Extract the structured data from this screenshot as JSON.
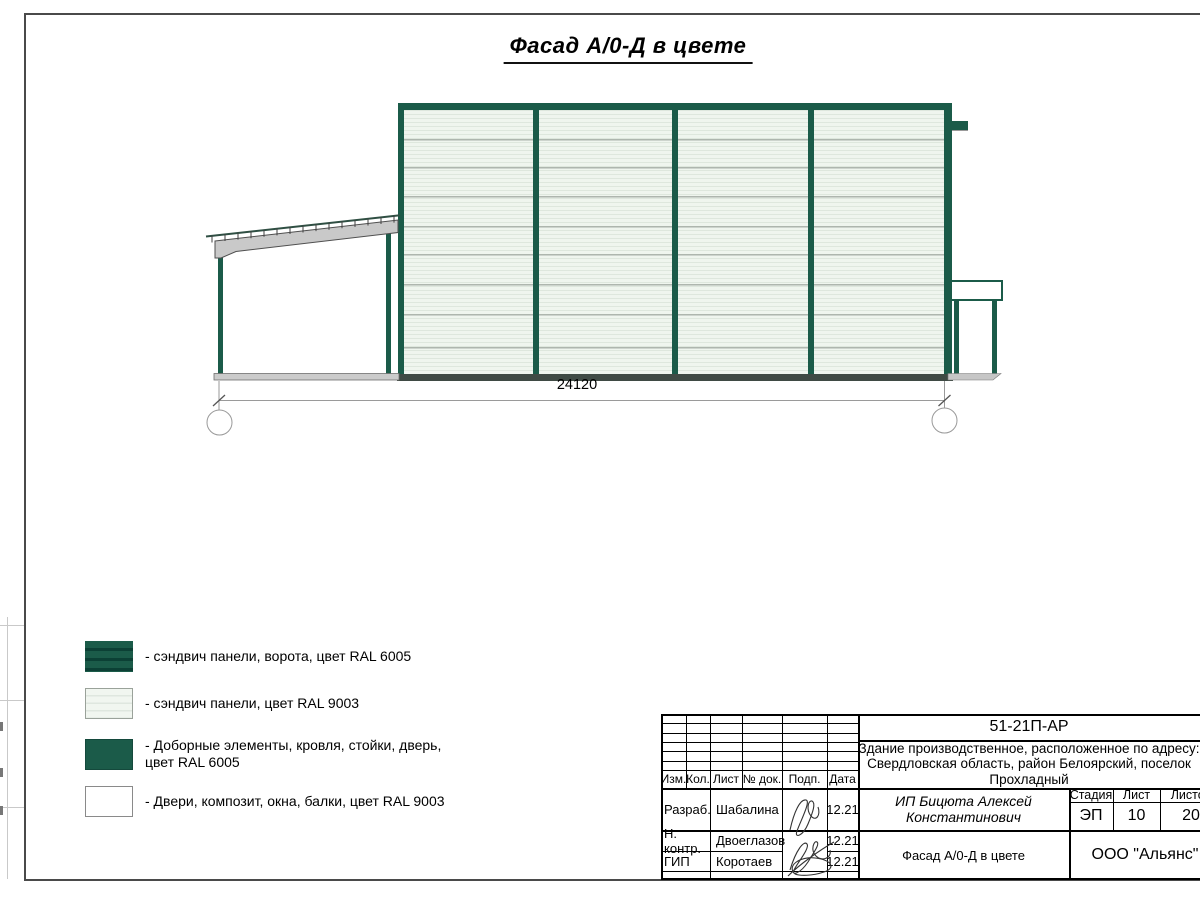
{
  "sheet": {
    "title": "Фасад А/0-Д в цвете"
  },
  "facade": {
    "dimension": "24120",
    "axis_left": "А/0",
    "axis_right": "Д"
  },
  "legend": {
    "items": [
      {
        "swatch": "gate-sandwich-panel-ral6005",
        "label": "- сэндвич панели, ворота, цвет RAL 6005"
      },
      {
        "swatch": "sandwich-panel-ral9003",
        "label": "- сэндвич панели, цвет RAL 9003"
      },
      {
        "swatch": "trim-elements-ral6005",
        "label": "- Доборные элементы, кровля, стойки, дверь,\nцвет RAL 6005"
      },
      {
        "swatch": "doors-windows-ral9003",
        "label": "- Двери, композит, окна, балки, цвет RAL 9003"
      }
    ]
  },
  "colors": {
    "ral6005": "#1b5b49",
    "ral6005_dark": "#0c4035",
    "ral9003": "#eff5ee",
    "panel_joint": "#9ea79e",
    "steel_gray": "#c9c9c9"
  },
  "title_block": {
    "doc_code": "51-21П-АР",
    "project": "Здание производственное, расположенное по адресу:\nСвердловская область, район Белоярский, поселок\nПрохладный",
    "columns": {
      "izm": "Изм.",
      "kol": "Кол.",
      "list": "Лист",
      "doc": "№ док.",
      "podp": "Подп.",
      "data": "Дата"
    },
    "rows": [
      {
        "role": "Разраб.",
        "name": "Шабалина",
        "date": "12.21"
      },
      {
        "role": "Н. контр.",
        "name": "Двоеглазов",
        "date": "12.21"
      },
      {
        "role": "ГИП",
        "name": "Коротаев",
        "date": "12.21"
      }
    ],
    "client": "ИП Бицюта Алексей\nКонстантинович",
    "stage_label": "Стадия",
    "sheet_label": "Лист",
    "sheets_label": "Листов",
    "stage": "ЭП",
    "sheet_no": "10",
    "sheets_total": "20",
    "drawing_title": "Фасад А/0-Д в цвете",
    "company": "ООО \"Альянс\""
  }
}
